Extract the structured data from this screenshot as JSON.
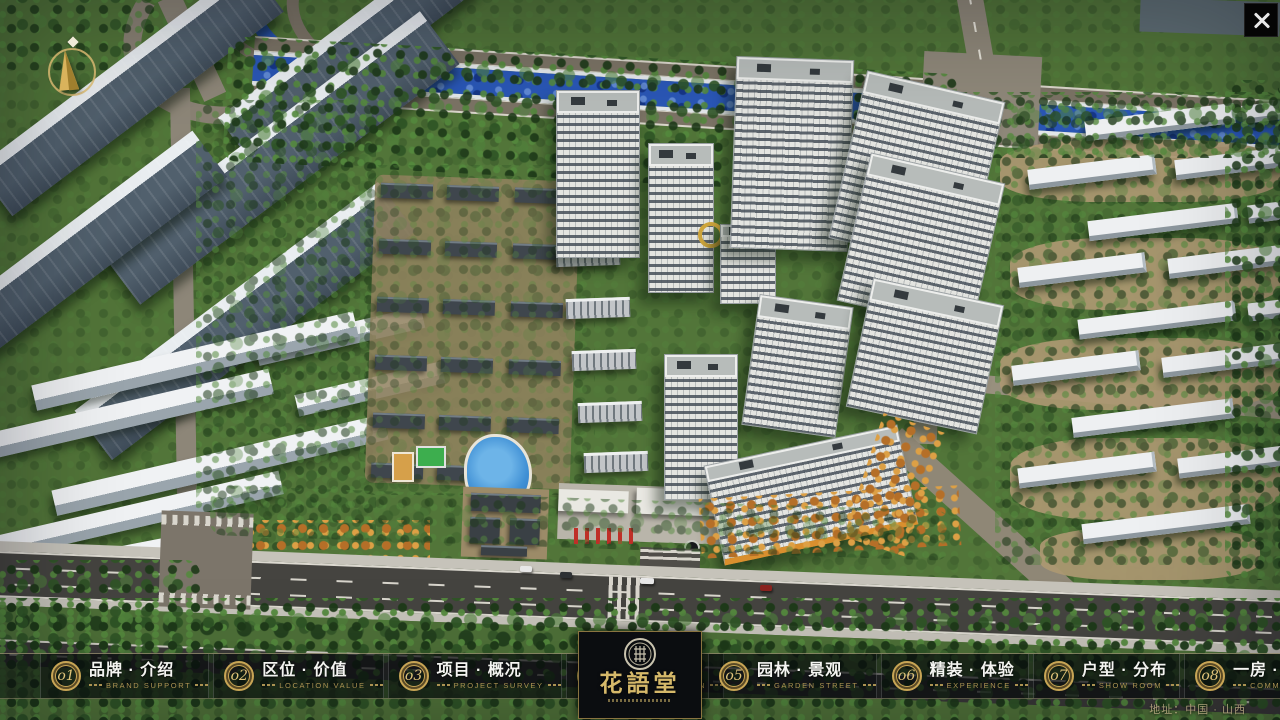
{
  "app": {
    "name": "花語堂 property presentation",
    "titlebar": {
      "close_icon": "close-x"
    }
  },
  "palette": {
    "gold_accent": "#C8A555",
    "gold_text": "#DEC379",
    "nav_background": "rgba(8,11,14,0.52)",
    "logo_panel_background": "#0B0D10",
    "river_blue": "#2A57B6",
    "grass_green": "#527539",
    "asphalt": "#454440",
    "flag_red": "#BF2F28"
  },
  "compass": {
    "icon": "compass-needle",
    "marker": "N"
  },
  "nav": {
    "items": [
      {
        "num": "o1",
        "zh": "品牌 · 介绍",
        "en": "BRAND SUPPORT"
      },
      {
        "num": "o2",
        "zh": "区位 · 价值",
        "en": "LOCATION VALUE"
      },
      {
        "num": "o3",
        "zh": "项目 · 概况",
        "en": "PROJECT SURVEY"
      },
      {
        "num": "o4",
        "zh": "建筑 · 鉴赏",
        "en": "APPRECIATION"
      },
      {
        "num": "o5",
        "zh": "园林 · 景观",
        "en": "GARDEN STREET"
      },
      {
        "num": "o6",
        "zh": "精装 · 体验",
        "en": "EXPERIENCE"
      },
      {
        "num": "o7",
        "zh": "户型 · 分布",
        "en": "SHOW ROOM"
      },
      {
        "num": "o8",
        "zh": "一房 · 一景",
        "en": "COMMUNITY"
      }
    ]
  },
  "logo": {
    "title": "花語堂",
    "seal_icon": "round-seal"
  },
  "footer": {
    "address": "地址：中国 · 山西"
  }
}
